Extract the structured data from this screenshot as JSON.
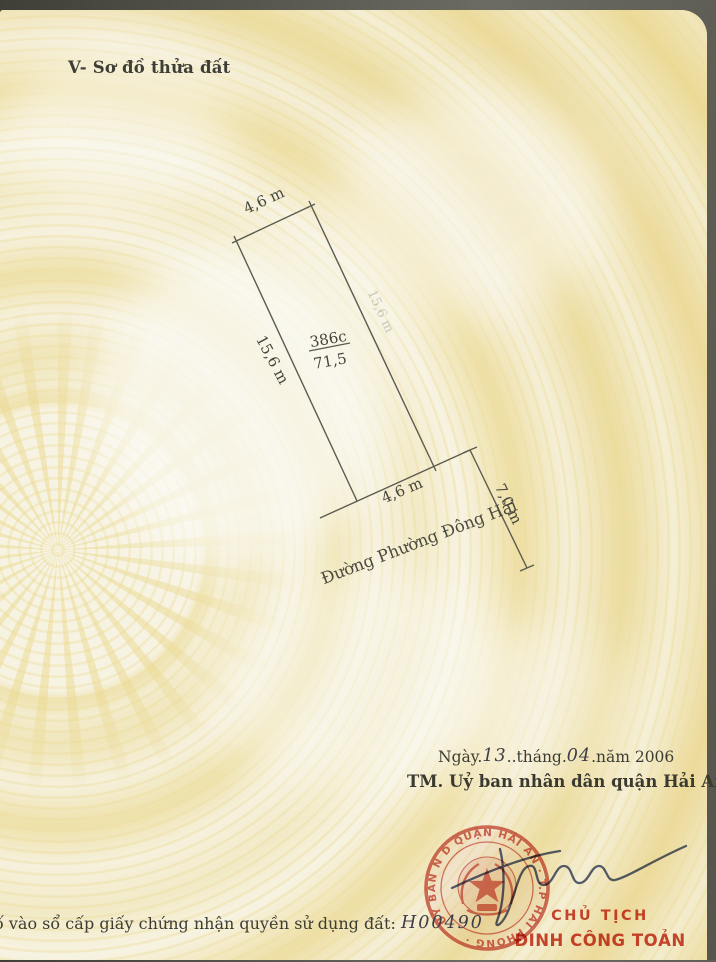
{
  "document": {
    "section_title": "V- Sơ đồ thửa đất",
    "footer_label": "ố vào sổ cấp giấy chứng nhận quyền sử dụng đất:",
    "footer_number": "H00490"
  },
  "diagram": {
    "top_width": "4,6 m",
    "left_length": "15,6 m",
    "right_length": "15,6 m",
    "parcel_code": "386c",
    "parcel_area": "71,5",
    "bottom_width": "4,6 m",
    "road_width": "7,0 m",
    "road_name": "Đường Phường Đông Hải"
  },
  "issuance": {
    "date_part1": "Ngày.",
    "day_handwritten": "13",
    "date_part2": "..tháng.",
    "month_handwritten": "04",
    "date_part3": ".năm 2006",
    "authority_line": "TM. Uỷ ban nhân dân quận Hải An",
    "signer_title": "CHỦ TỊCH",
    "signer_name": "ĐINH CÔNG TOẢN"
  },
  "stamp": {
    "ring_text": "UỶ BAN N D QUẬN HẢI AN · T.P HẢI PHÒNG ·"
  },
  "colors": {
    "paper_cream": "#f5efd9",
    "pattern_yellow": "#eedfa4",
    "ink_dark": "#45453b",
    "stamp_red": "#c8453a",
    "signature_blue": "#32406f",
    "frame_gray": "#5a5a52"
  }
}
